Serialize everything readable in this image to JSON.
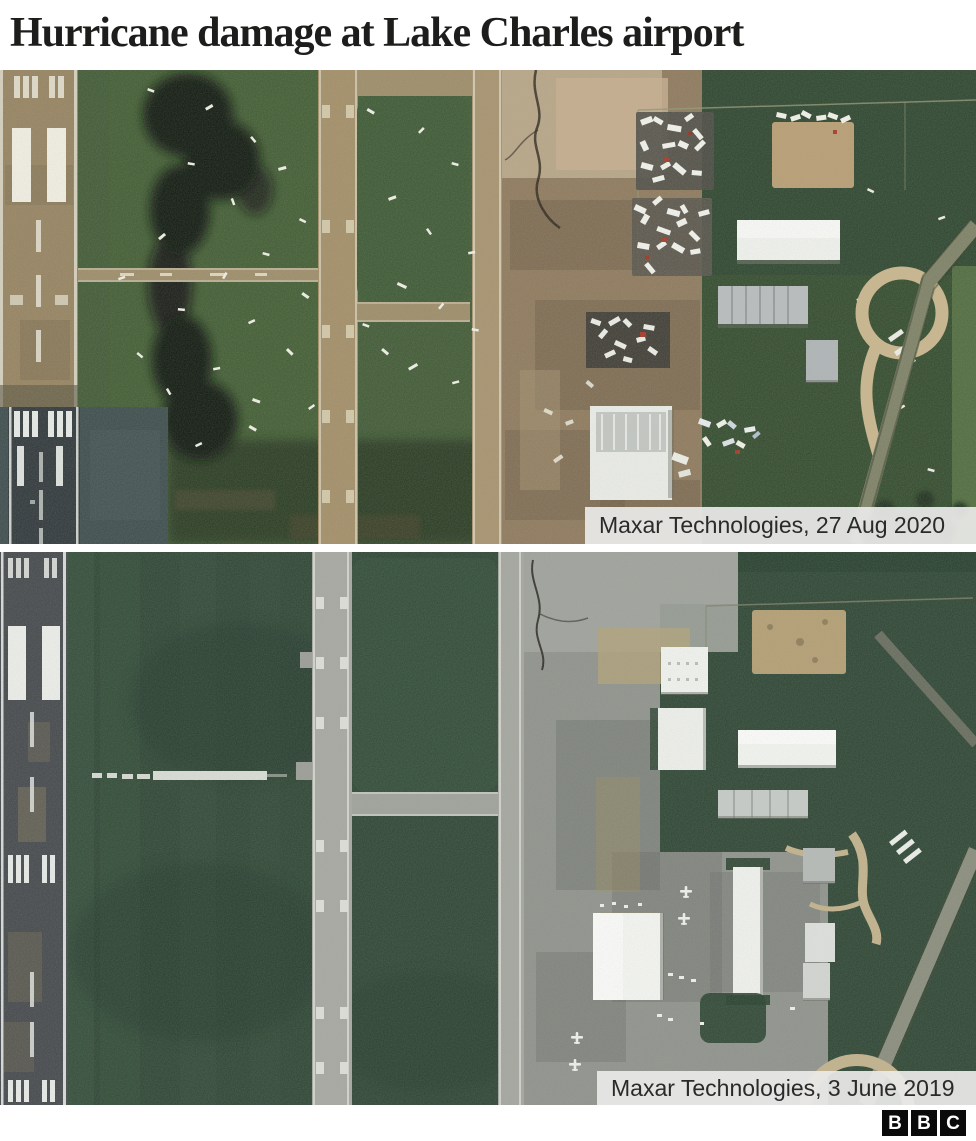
{
  "header": {
    "title": "Hurricane damage at Lake Charles airport"
  },
  "images": [
    {
      "caption": "Maxar Technologies, 27 Aug 2020"
    },
    {
      "caption": "Maxar Technologies, 3 June 2019"
    }
  ],
  "footer": {
    "logo": [
      "B",
      "B",
      "C"
    ]
  },
  "colors": {
    "title_text": "#1d1d1b",
    "caption_bg": "#e9eae8",
    "caption_text": "#2a2a2a",
    "logo_bg": "#0a0a0a",
    "logo_text": "#ffffff",
    "grass_2020": "#3e5833",
    "grass_2019": "#2c4432",
    "apron_2020": "#8d785b",
    "apron_2019": "#8e928b",
    "runway_2019": "#43474a"
  }
}
